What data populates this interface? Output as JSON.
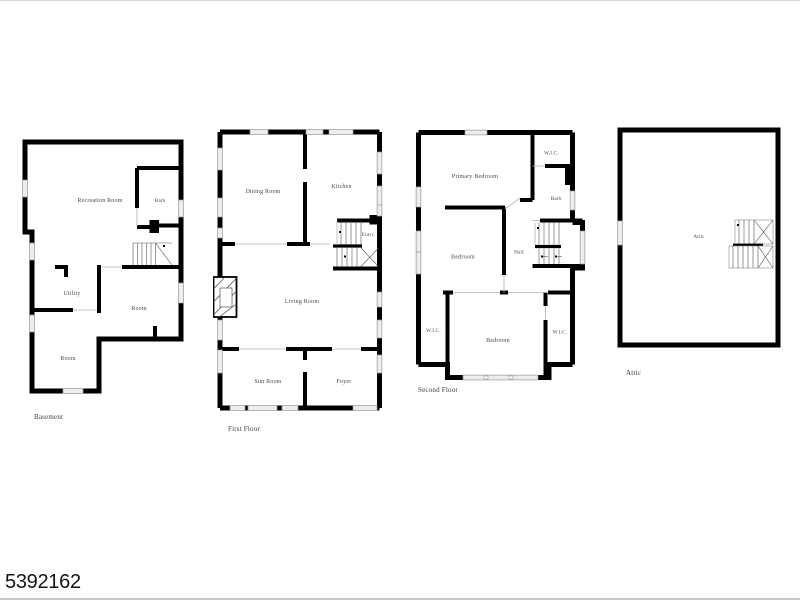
{
  "page": {
    "listing_id": "5392162",
    "background": "#ffffff",
    "frame_line_color": "#d6d9dc"
  },
  "colors": {
    "wall": "#000000",
    "window_fill": "#ededed",
    "window_stroke": "#9a9a9a",
    "open_boundary_line": "#b3b3b3",
    "stair_line": "#555555",
    "room_label_text": "#4a4a4a",
    "listing_id_text": "#141414"
  },
  "plans": {
    "basement": {
      "label": "Basement",
      "rooms": {
        "recreation": "Recreation Room",
        "bath": "Bath",
        "utility": "Utility",
        "room_middle": "Room",
        "room_lower": "Room"
      }
    },
    "first": {
      "label": "First Floor",
      "rooms": {
        "dining": "Dining Room",
        "kitchen": "Kitchen",
        "entry": "Entry",
        "living": "Living Room",
        "sun": "Sun Room",
        "foyer": "Foyer"
      }
    },
    "second": {
      "label": "Second Floor",
      "rooms": {
        "primary": "Primary Bedroom",
        "wic_top": "W.I.C.",
        "bath": "Bath",
        "bedroom_middle": "Bedroom",
        "hall": "Hall",
        "wic_left": "W.I.C.",
        "bedroom_lower": "Bedroom",
        "wic_right": "W.I.C."
      }
    },
    "attic": {
      "label": "Attic",
      "rooms": {
        "attic": "Attic"
      }
    }
  }
}
